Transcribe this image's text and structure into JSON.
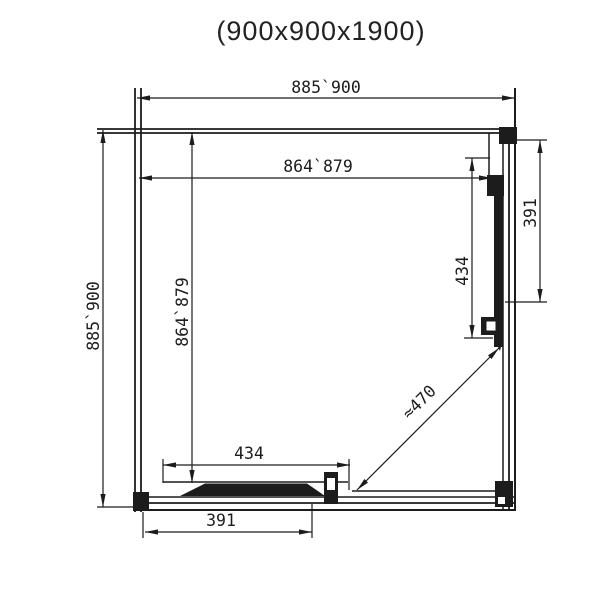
{
  "title": "(900x900x1900)",
  "dimensions": {
    "top_outer": "885`900",
    "top_inner": "864`879",
    "left_outer": "885`900",
    "left_inner": "864`879",
    "right_fixed": "391",
    "right_door": "434",
    "bottom_door": "434",
    "bottom_fixed": "391",
    "diagonal": "≈470"
  }
}
